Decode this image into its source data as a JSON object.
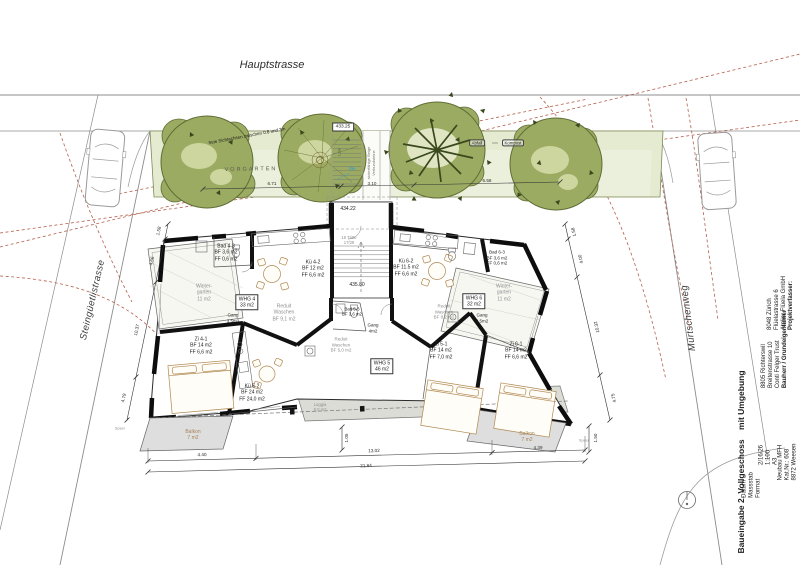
{
  "streets": {
    "hauptstrasse": "Hauptstrasse",
    "steinguetlistrasse": "Steingüetlistrasse",
    "muertschenweg": "Mürtschenweg"
  },
  "site": {
    "vorgarten": "VORGARTEN",
    "sight_note": "freie Sichtachsen zwischen 0.8 und 3m",
    "abfall": "Abfall",
    "kompost": "Kompost",
    "paving_note_1": "sickerfähige Beige",
    "paving_note_2": "Verbundsteine",
    "slope": "1%",
    "outdoor_stair_width": "1,2m",
    "speer": "Speer"
  },
  "levels": {
    "street": "433.25",
    "entrance": "434.22",
    "floor": "435.80"
  },
  "stair": {
    "l1": "16 Tritte",
    "l2": "17/29"
  },
  "rooms": {
    "bad43": {
      "l1": "Bad 4-3",
      "l2": "BF 3,6 m2",
      "l3": "FF 0,6 m2"
    },
    "ku42": {
      "l1": "Kü 4-2",
      "l2": "BF 12 m2",
      "l3": "FF 6,6 m2"
    },
    "wg_left": {
      "l1": "Winter-",
      "l2": "garten",
      "l3": "11 m2"
    },
    "whg4": {
      "l1": "WHG 4",
      "l2": "33 m2"
    },
    "gang4": {
      "l1": "Gang",
      "l2": "3,5m2"
    },
    "reduit4": {
      "l1": "Reduit",
      "l2": "Waschen",
      "l3": "BF 9,1 m2"
    },
    "zi41": {
      "l1": "Zi 4-1",
      "l2": "BF 14 m2",
      "l3": "FF 6,6 m2"
    },
    "bad53": {
      "l1": "Bad 5-3",
      "l2": "BF 3,6 m2"
    },
    "reduit5": {
      "l1": "Reduit",
      "l2": "Waschen",
      "l3": "BF 5,0 m2"
    },
    "whg5": {
      "l1": "WHG 5",
      "l2": "46 m2"
    },
    "gang5": {
      "l1": "Gang",
      "l2": "4m2"
    },
    "ku52": {
      "l1": "Kü 5-2",
      "l2": "BF 24 m2",
      "l3": "FF 24,0 m2"
    },
    "ku62": {
      "l1": "Kü 6-2",
      "l2": "BF 11.5 m2",
      "l3": "FF 6,6 m2"
    },
    "bad63": {
      "l1": "Bad 6-3",
      "l2": "BF 3,6 m2",
      "l3": "FF 0,6 m2"
    },
    "wg_right": {
      "l1": "Winter-",
      "l2": "garten",
      "l3": "11 m2"
    },
    "whg6": {
      "l1": "WHG 6",
      "l2": "32 m2"
    },
    "gang6": {
      "l1": "Gang",
      "l2": "3,5m2"
    },
    "reduit6": {
      "l1": "Reduit",
      "l2": "Waschen",
      "l3": "BF 8,2 m2"
    },
    "zi51": {
      "l1": "Zi 5-1",
      "l2": "BF 14 m2",
      "l3": "FF 7,0 m2"
    },
    "zi61": {
      "l1": "Zi 6-1",
      "l2": "BF 14 m2",
      "l3": "FF 6,6 m2"
    },
    "loggia": {
      "l1": "Loggia",
      "l2": "8,0 m2"
    },
    "balkon_left": {
      "l1": "Balkon",
      "l2": "7 m2"
    },
    "balkon_right": {
      "l1": "Balkon",
      "l2": "7 m2"
    }
  },
  "dims": {
    "top_1": "6.71",
    "top_2": "3.10",
    "top_3": "6.58",
    "left_1": "1.58",
    "left_2": "4.66",
    "left_3": "10.37",
    "left_4": "4.79",
    "right_1": "1.58",
    "right_2": "4.00",
    "right_3": "10.32",
    "right_4": "4.75",
    "balkon_right_depth": "1.50",
    "loggia_depth": "1.05",
    "bottom_left": "4.40",
    "bottom_mid": "13.02",
    "bottom_right": "4.39",
    "bottom_total": "21.84"
  },
  "title_block": {
    "title": "Baueingabe 2. Vollgeschoss    mit Umgebung",
    "meta_labels": [
      "Datum",
      "Massstab",
      "Format"
    ],
    "meta_values": [
      "2/16/26",
      "1:100",
      "A3"
    ],
    "object_lines": [
      "Neubau MFH",
      "Kat.Nr.: 608",
      "8872 Weesen"
    ],
    "client_header": "Bauherr / Grundeigentümer",
    "client_lines": [
      "Conti Felger Trust",
      "Breitenstrasse 10",
      "8805 Richterswil"
    ],
    "author_header": "Projektverfasser:",
    "author_lines": [
      "Atelier Flüela GmbH",
      "Flüelastrasse 6",
      "8048 Zürich"
    ]
  },
  "palette": {
    "canopy": "#9cab62",
    "canopy_dark": "#3a481d",
    "greenspace": "#e4ebd1",
    "paving": "#dcdcd6",
    "dash_red": "#b5604c",
    "slope_cyan": "#2fa3c7",
    "furniture_tan": "#b08850"
  }
}
